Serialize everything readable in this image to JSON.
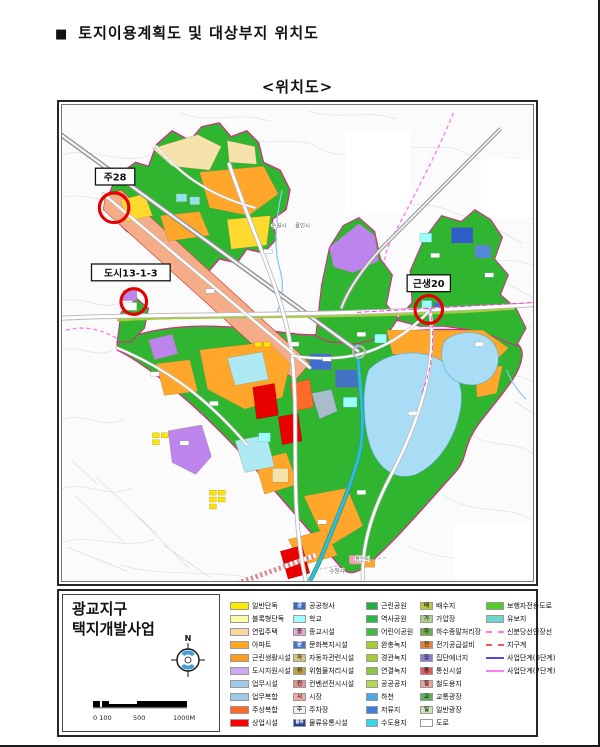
{
  "page": {
    "title_bullet": "■",
    "title": "토지이용계획도 및 대상부지 위치도",
    "subtitle": "<위치도>"
  },
  "map": {
    "callouts": [
      {
        "label": "주28"
      },
      {
        "label": "도시13-1-3"
      },
      {
        "label": "근생20"
      }
    ],
    "city_labels": {
      "top_left": "수원시",
      "top_right": "용인시",
      "bottom_right": "용인시",
      "bottom_left": "수원시"
    },
    "callout_circle_color": "#E60000",
    "district_boundary_color": "#E0218A"
  },
  "legend": {
    "project_name_line1": "광교지구",
    "project_name_line2": "택지개발사업",
    "north_label": "N",
    "scale_labels": [
      "0 100",
      "500",
      "1000M"
    ],
    "columns": [
      {
        "items": [
          {
            "label": "일반단독",
            "color": "#FFEB00",
            "pattern": "solid"
          },
          {
            "label": "블록형단독",
            "color": "#FFFCA8",
            "pattern": "solid"
          },
          {
            "label": "연립주택",
            "color": "#FAD7A0",
            "pattern": "solid"
          },
          {
            "label": "아파트",
            "color": "#FFA623",
            "pattern": "solid"
          },
          {
            "label": "근린생활시설",
            "color": "#FF9A1F",
            "pattern": "dots"
          },
          {
            "label": "도시지원시설",
            "color": "#CDA6F0",
            "pattern": "solid"
          },
          {
            "label": "업무시설",
            "color": "#9CC9E8",
            "pattern": "solid"
          },
          {
            "label": "업무복합",
            "color": "#9CC9E8",
            "pattern": "hatch"
          },
          {
            "label": "주상복합",
            "color": "#FF6A2A",
            "pattern": "dots"
          },
          {
            "label": "상업시설",
            "color": "#FF0000",
            "pattern": "solid"
          }
        ]
      },
      {
        "items": [
          {
            "label": "공공청사",
            "color": "#3A6BC8",
            "letter": "공",
            "letter_color": "#ffffff"
          },
          {
            "label": "학교",
            "color": "#9FFFFF"
          },
          {
            "label": "종교시설",
            "color": "#EFA3CF",
            "letter": "종",
            "letter_color": "#333333"
          },
          {
            "label": "문화복지시설",
            "color": "#4472C4",
            "letter": "문",
            "letter_color": "#ffffff"
          },
          {
            "label": "자동차관련시설",
            "color": "#D8C27C",
            "letter": "자",
            "letter_color": "#333333"
          },
          {
            "label": "위험물처리시설",
            "color": "#BFA145",
            "letter": "위",
            "letter_color": "#333333"
          },
          {
            "label": "컨벤션전시시설",
            "color": "#E88F8F",
            "letter": "컨",
            "letter_color": "#333333"
          },
          {
            "label": "시장",
            "color": "#F8A6A6",
            "letter": "시",
            "letter_color": "#333333"
          },
          {
            "label": "주차장",
            "color": "#F2F2F2",
            "letter": "주",
            "letter_color": "#333333"
          },
          {
            "label": "물류유통시설",
            "color": "#27408F",
            "letter": "물류",
            "letter_color": "#ffffff"
          }
        ]
      },
      {
        "items": [
          {
            "label": "근린공원",
            "color": "#1FAF3C"
          },
          {
            "label": "역사공원",
            "color": "#2BB54A"
          },
          {
            "label": "어린이공원",
            "color": "#3DBE3D"
          },
          {
            "label": "완충녹지",
            "color": "#A4CE39"
          },
          {
            "label": "경관녹지",
            "color": "#A4CE39"
          },
          {
            "label": "연결녹지",
            "color": "#8CC63F"
          },
          {
            "label": "공공공지",
            "color": "#B3D94C"
          },
          {
            "label": "하천",
            "color": "#4DA6E8"
          },
          {
            "label": "저류지",
            "color": "#3F7FDE"
          },
          {
            "label": "수도용지",
            "color": "#35D6E8"
          }
        ]
      },
      {
        "items": [
          {
            "label": "배수지",
            "color": "#B9C93B",
            "letter": "배",
            "letter_color": "#333333"
          },
          {
            "label": "가압장",
            "color": "#A9D18E",
            "letter": "가",
            "letter_color": "#333333"
          },
          {
            "label": "하수종말처리장",
            "color": "#6FAE46",
            "letter": "하",
            "letter_color": "#333333"
          },
          {
            "label": "전기공급설비",
            "color": "#E2833C",
            "letter": "전",
            "letter_color": "#333333"
          },
          {
            "label": "집단에너지",
            "color": "#8A7FD6",
            "letter": "집",
            "letter_color": "#333333"
          },
          {
            "label": "통신시설",
            "color": "#E25B5B",
            "letter": "통",
            "letter_color": "#333333"
          },
          {
            "label": "철도용지",
            "color": "#F2A09A",
            "letter": "철",
            "letter_color": "#333333"
          },
          {
            "label": "교통광장",
            "color": "#57B457",
            "letter": "교",
            "letter_color": "#333333"
          },
          {
            "label": "일반광장",
            "color": "#C9E6B4",
            "letter": "일",
            "letter_color": "#333333"
          },
          {
            "label": "도로",
            "color": "#FFFFFF"
          }
        ]
      },
      {
        "items": [
          {
            "label": "보행자전용도로",
            "color": "#52CC29"
          },
          {
            "label": "유보지",
            "color": "#6FD6CF"
          },
          {
            "label": "신분당선연장선",
            "type": "line",
            "line_style": "dashed",
            "color": "#FF7DE8"
          },
          {
            "label": "지구계",
            "type": "line",
            "line_style": "dashed",
            "color": "#F25B5B"
          },
          {
            "label": "사업단계(6단계)",
            "type": "line",
            "line_style": "solid",
            "color": "#4A4AE8"
          },
          {
            "label": "사업단계(7단계)",
            "type": "line",
            "line_style": "solid",
            "color": "#FF7DF2"
          }
        ]
      }
    ]
  }
}
